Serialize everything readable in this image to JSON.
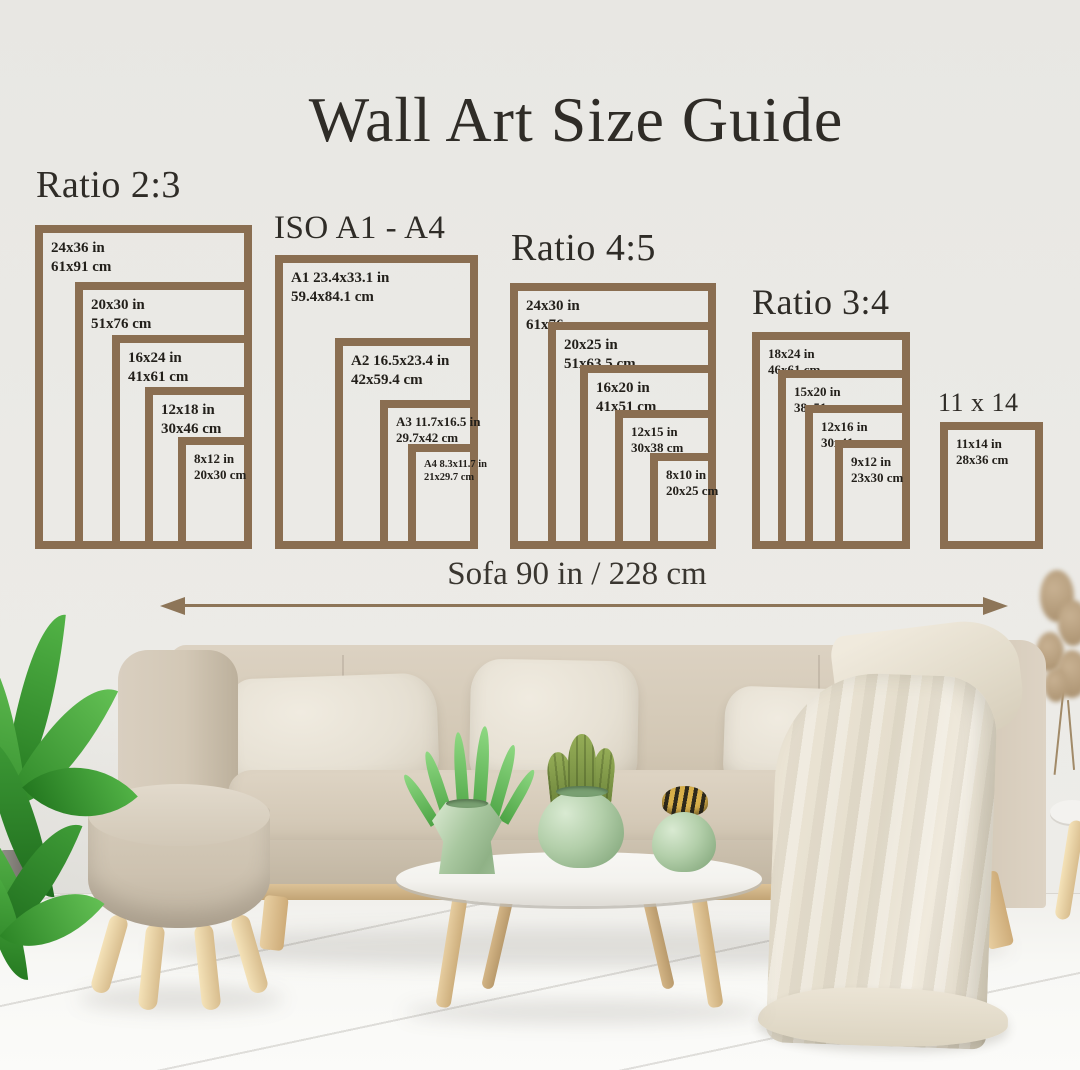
{
  "title": "Wall Art Size Guide",
  "dimension": {
    "label": "Sofa 90 in / 228 cm"
  },
  "colors": {
    "frame": "#8a6e51",
    "arrow": "#8d7558",
    "heading": "#2f2c27",
    "wall": "#eaE9e5",
    "vase_green": "#a9c8a0"
  },
  "groups": [
    {
      "heading": "Ratio 2:3",
      "frames": [
        {
          "inches": "24x36 in",
          "cm": "61x91 cm"
        },
        {
          "inches": "20x30 in",
          "cm": "51x76 cm"
        },
        {
          "inches": "16x24 in",
          "cm": "41x61 cm"
        },
        {
          "inches": "12x18 in",
          "cm": "30x46 cm"
        },
        {
          "inches": "8x12 in",
          "cm": "20x30 cm"
        }
      ]
    },
    {
      "heading": "ISO A1 - A4",
      "frames": [
        {
          "inches": "A1 23.4x33.1 in",
          "cm": "59.4x84.1 cm"
        },
        {
          "inches": "A2 16.5x23.4 in",
          "cm": "42x59.4 cm"
        },
        {
          "inches": "A3 11.7x16.5 in",
          "cm": "29.7x42 cm"
        },
        {
          "inches": "A4 8.3x11.7 in",
          "cm": "21x29.7 cm"
        }
      ]
    },
    {
      "heading": "Ratio 4:5",
      "frames": [
        {
          "inches": "24x30 in",
          "cm": "61x76 cm"
        },
        {
          "inches": "20x25 in",
          "cm": "51x63.5 cm"
        },
        {
          "inches": "16x20 in",
          "cm": "41x51 cm"
        },
        {
          "inches": "12x15 in",
          "cm": "30x38 cm"
        },
        {
          "inches": "8x10 in",
          "cm": "20x25 cm"
        }
      ]
    },
    {
      "heading": "Ratio 3:4",
      "frames": [
        {
          "inches": "18x24 in",
          "cm": "46x61 cm"
        },
        {
          "inches": "15x20 in",
          "cm": "38x51 cm"
        },
        {
          "inches": "12x16 in",
          "cm": "30x41 cm"
        },
        {
          "inches": "9x12 in",
          "cm": "23x30 cm"
        }
      ]
    },
    {
      "heading": "11 x 14",
      "frames": [
        {
          "inches": "11x14 in",
          "cm": "28x36 cm"
        }
      ]
    }
  ]
}
